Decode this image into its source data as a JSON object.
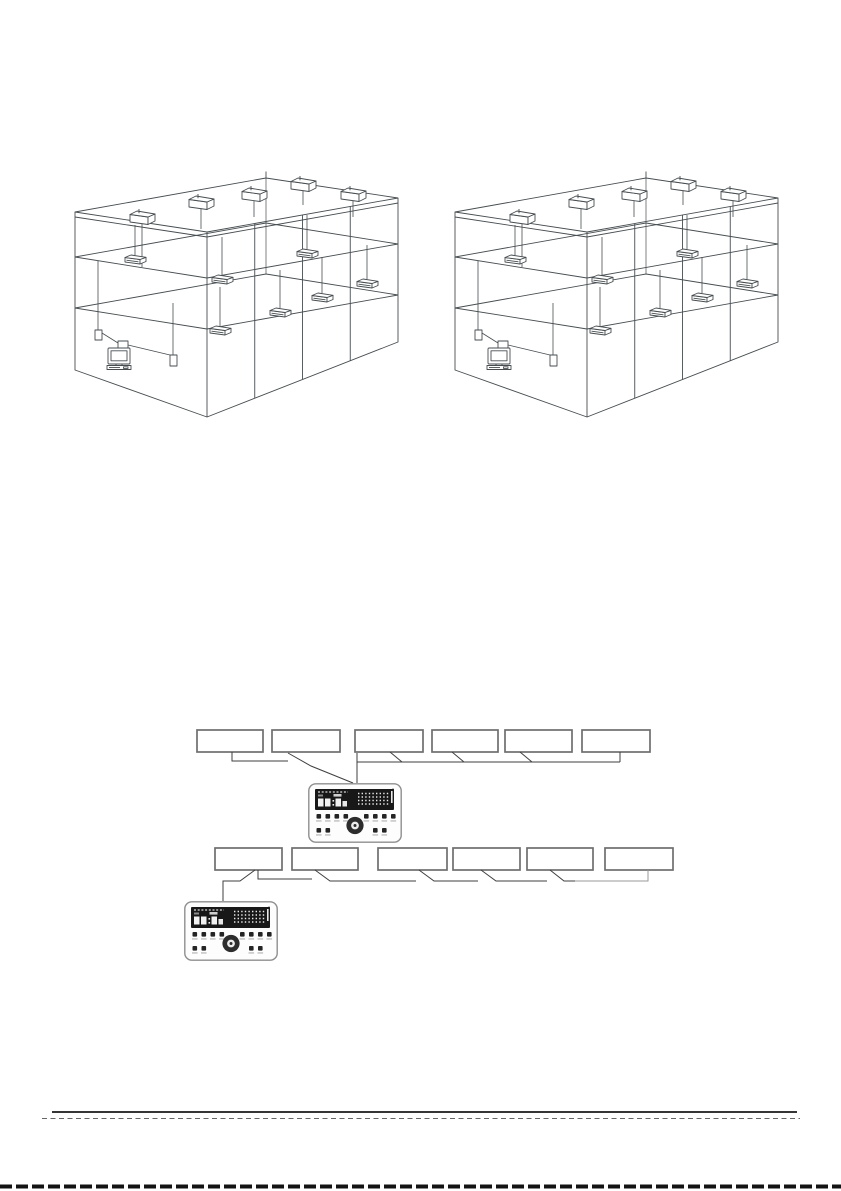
{
  "page": {
    "kind": "installation-manual-diagram-page",
    "background_color": "#ffffff"
  },
  "building_figures": [
    {
      "id": "building-left",
      "floors": 3,
      "bays": 4,
      "rooftop_units": 5,
      "indoor_units": 7,
      "computers": 1
    },
    {
      "id": "building-right",
      "floors": 3,
      "bays": 4,
      "rooftop_units": 5,
      "indoor_units": 7,
      "computers": 1
    }
  ],
  "callout_figures": [
    {
      "id": "controller-callout-top",
      "label_boxes": 6,
      "device": "wired-remote-controller"
    },
    {
      "id": "controller-callout-bottom",
      "label_boxes": 6,
      "device": "wired-remote-controller"
    }
  ],
  "colors": {
    "diagram_line": "#474d50",
    "callout_line": "#3f3f3f",
    "box_border": "#6e6e6e",
    "controller_display": "#181818",
    "footer_rule": "#1a1a1a",
    "footer_dash": "#666666",
    "bottom_cut_line": "#131313"
  }
}
